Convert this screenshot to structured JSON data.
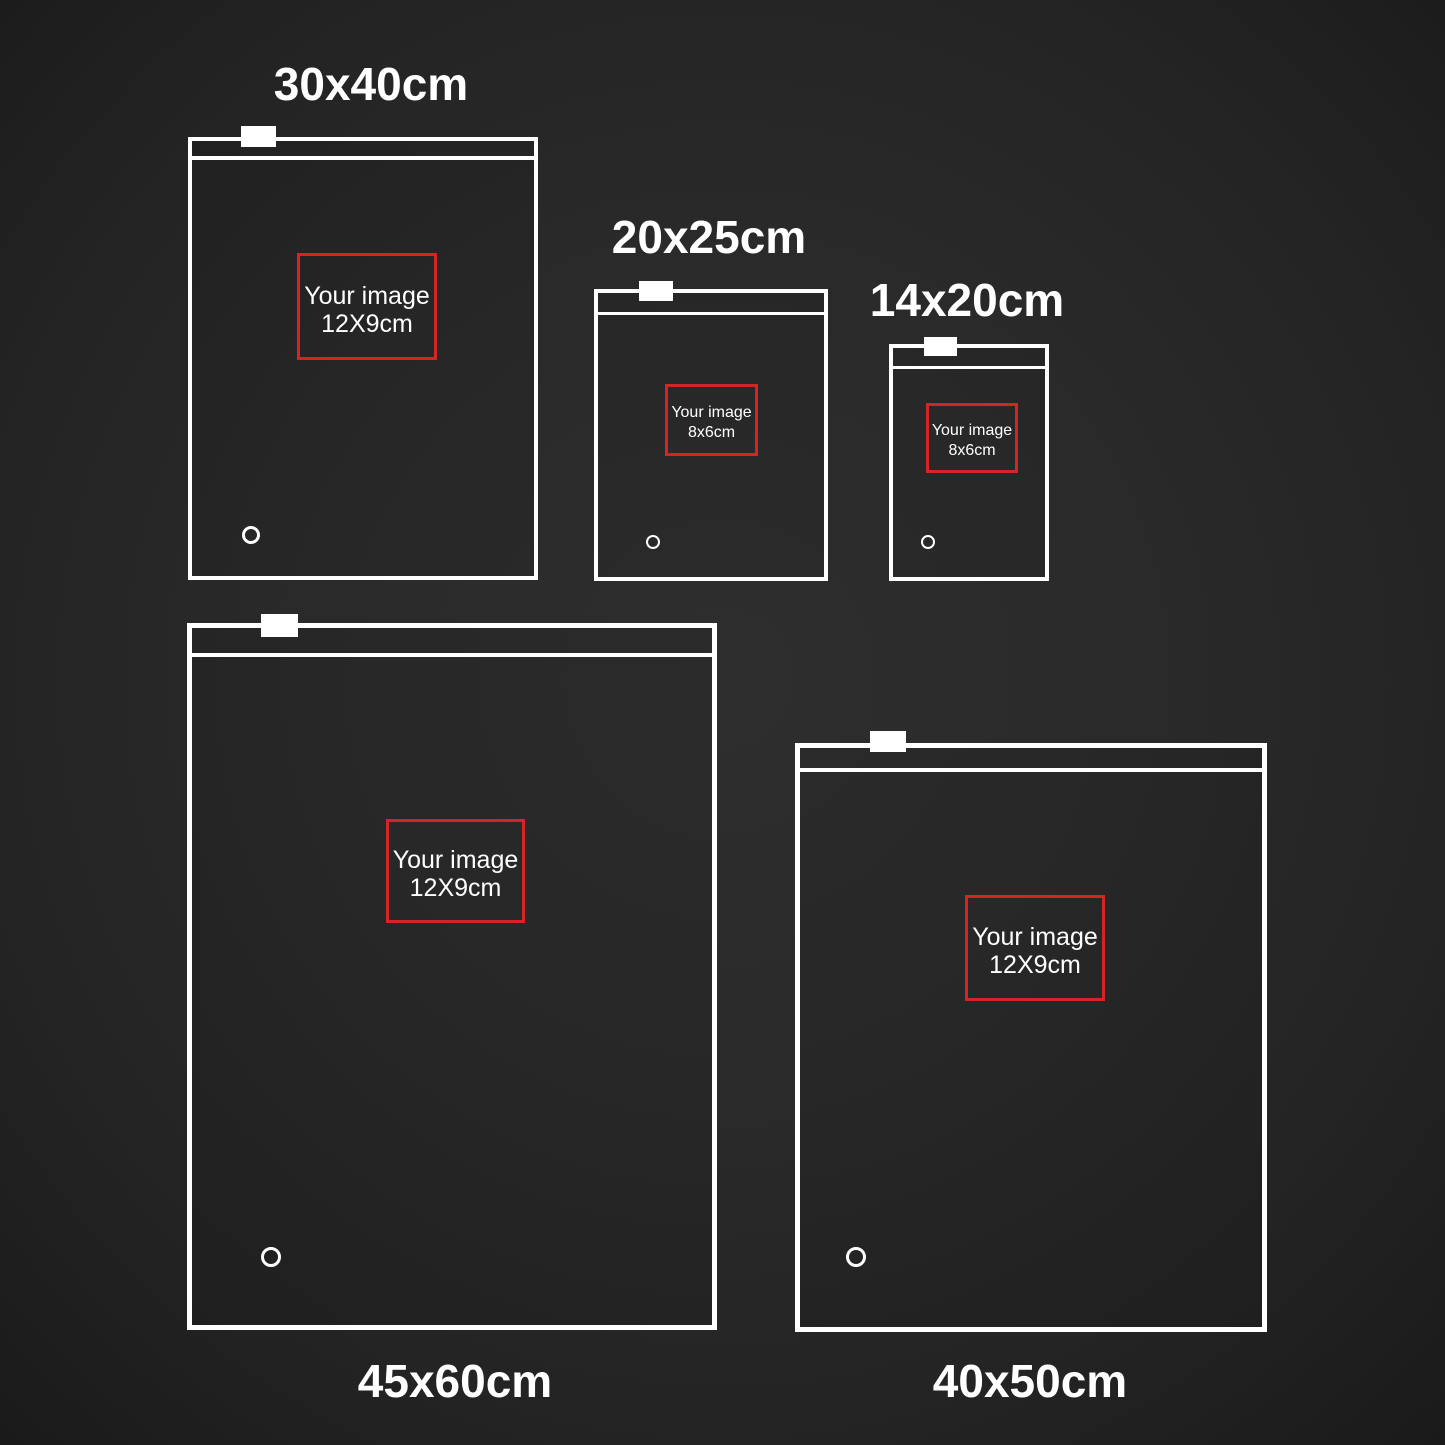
{
  "colors": {
    "background_center": "#2e2e2e",
    "background_edge": "#1a1a1a",
    "bag_outline": "#ffffff",
    "placeholder_outline": "#d32522",
    "text": "#ffffff"
  },
  "bags": [
    {
      "label": "30x40cm",
      "placeholder": {
        "line1": "Your image",
        "line2": "12X9cm"
      },
      "layout": {
        "x": 188,
        "y": 137,
        "w": 350,
        "h": 443,
        "border": 4,
        "zip_y": 156,
        "zip_h": 4,
        "tab": {
          "x": 241,
          "y": 126,
          "w": 35,
          "h": 21
        },
        "box": {
          "x": 297,
          "y": 253,
          "w": 140,
          "h": 107
        },
        "font": 25,
        "lh": 28,
        "hole": {
          "cx": 251,
          "cy": 535,
          "r": 9,
          "stroke": 3
        },
        "label_pos": {
          "cx": 371,
          "cy": 84
        }
      }
    },
    {
      "label": "20x25cm",
      "placeholder": {
        "line1": "Your image",
        "line2": "8x6cm"
      },
      "layout": {
        "x": 594,
        "y": 289,
        "w": 234,
        "h": 292,
        "border": 4,
        "zip_y": 312,
        "zip_h": 3,
        "tab": {
          "x": 639,
          "y": 281,
          "w": 34,
          "h": 20
        },
        "box": {
          "x": 665,
          "y": 384,
          "w": 93,
          "h": 72
        },
        "font": 16,
        "lh": 20,
        "hole": {
          "cx": 653,
          "cy": 542,
          "r": 7,
          "stroke": 2
        },
        "label_pos": {
          "cx": 709,
          "cy": 237
        }
      }
    },
    {
      "label": "14x20cm",
      "placeholder": {
        "line1": "Your image",
        "line2": "8x6cm"
      },
      "layout": {
        "x": 889,
        "y": 344,
        "w": 160,
        "h": 237,
        "border": 4,
        "zip_y": 366,
        "zip_h": 3,
        "tab": {
          "x": 924,
          "y": 337,
          "w": 33,
          "h": 19
        },
        "box": {
          "x": 926,
          "y": 403,
          "w": 92,
          "h": 70
        },
        "font": 16,
        "lh": 20,
        "hole": {
          "cx": 928,
          "cy": 542,
          "r": 7,
          "stroke": 2
        },
        "label_pos": {
          "cx": 967,
          "cy": 300
        }
      }
    },
    {
      "label": "45x60cm",
      "placeholder": {
        "line1": "Your image",
        "line2": "12X9cm"
      },
      "layout": {
        "x": 187,
        "y": 623,
        "w": 530,
        "h": 707,
        "border": 5,
        "zip_y": 653,
        "zip_h": 4,
        "tab": {
          "x": 261,
          "y": 614,
          "w": 37,
          "h": 23
        },
        "box": {
          "x": 386,
          "y": 819,
          "w": 139,
          "h": 104
        },
        "font": 25,
        "lh": 28,
        "hole": {
          "cx": 271,
          "cy": 1257,
          "r": 10,
          "stroke": 3
        },
        "label_pos": {
          "cx": 455,
          "cy": 1381
        }
      }
    },
    {
      "label": "40x50cm",
      "placeholder": {
        "line1": "Your image",
        "line2": "12X9cm"
      },
      "layout": {
        "x": 795,
        "y": 743,
        "w": 472,
        "h": 589,
        "border": 5,
        "zip_y": 768,
        "zip_h": 4,
        "tab": {
          "x": 870,
          "y": 731,
          "w": 36,
          "h": 21
        },
        "box": {
          "x": 965,
          "y": 895,
          "w": 140,
          "h": 106
        },
        "font": 25,
        "lh": 28,
        "hole": {
          "cx": 856,
          "cy": 1257,
          "r": 10,
          "stroke": 3
        },
        "label_pos": {
          "cx": 1030,
          "cy": 1381
        }
      }
    }
  ]
}
